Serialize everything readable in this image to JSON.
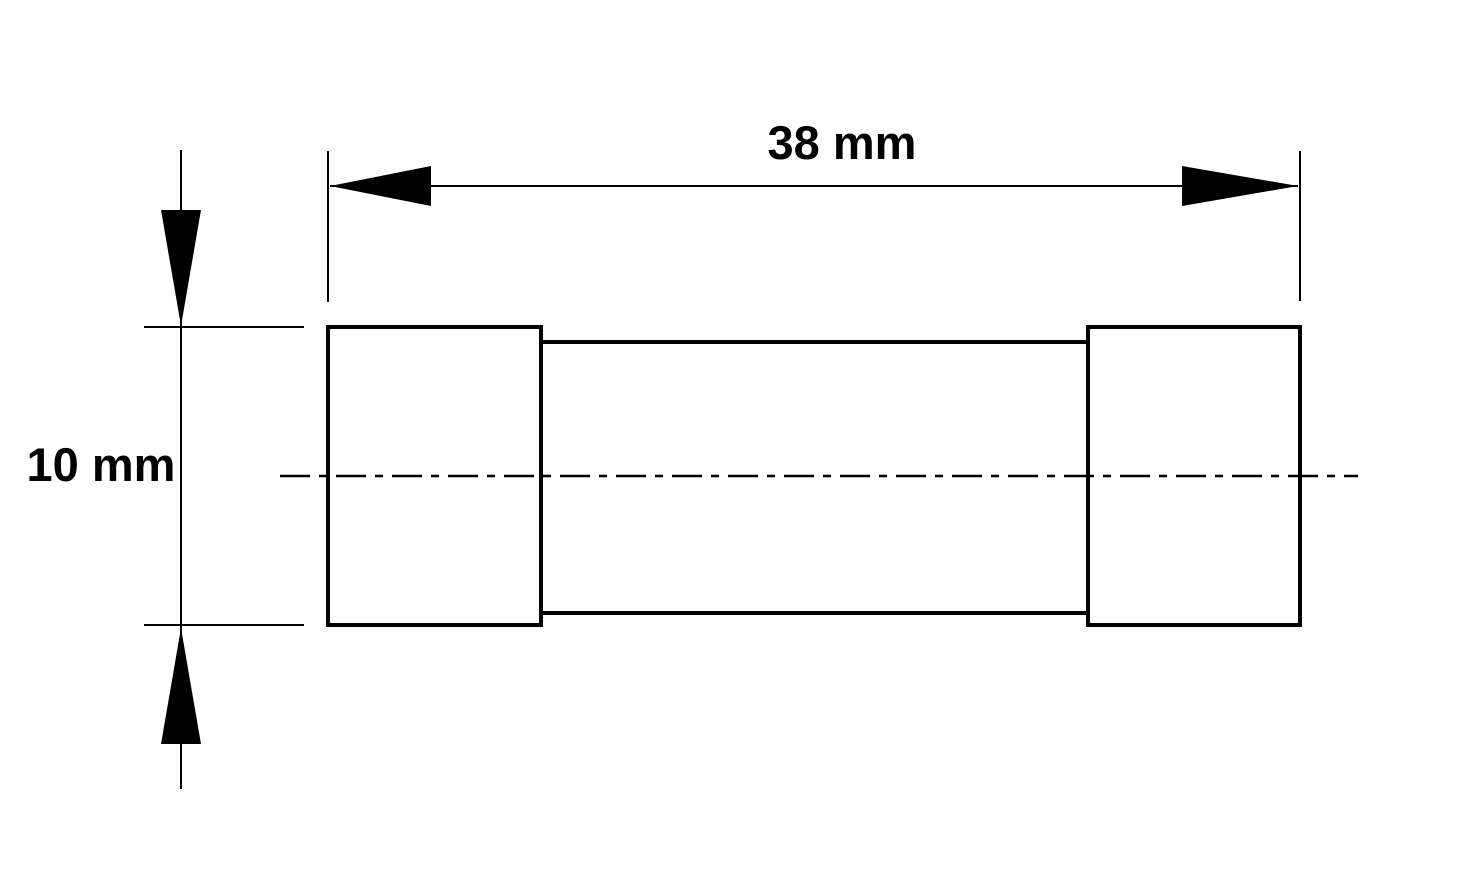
{
  "drawing": {
    "type": "technical-dimension-drawing",
    "subject": "cartridge fuse outline",
    "background_color": "#ffffff",
    "line_color": "#000000",
    "length_dimension": {
      "label": "38 mm"
    },
    "diameter_dimension": {
      "label": "10 mm"
    }
  }
}
